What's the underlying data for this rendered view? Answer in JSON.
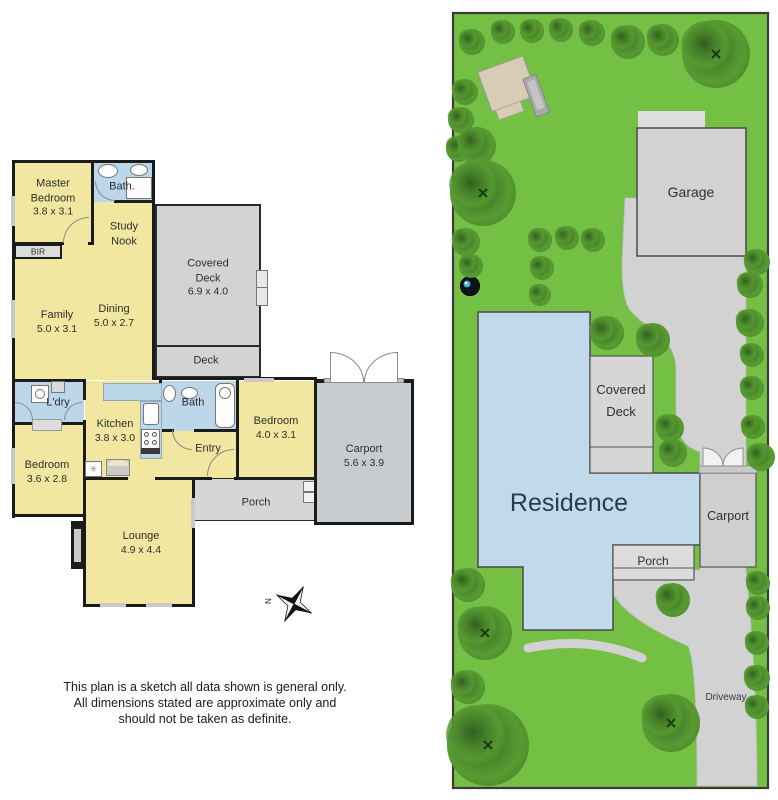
{
  "floorplan": {
    "labels": {
      "master_line1": "Master",
      "master_line2": "Bedroom",
      "master_dims": "3.8 x 3.1",
      "bath_top": "Bath.",
      "study_line1": "Study",
      "study_line2": "Nook",
      "bir": "BIR",
      "family": "Family",
      "family_dims": "5.0 x 3.1",
      "dining": "Dining",
      "dining_dims": "5.0 x 2.7",
      "covered_line1": "Covered",
      "covered_line2": "Deck",
      "covered_dims": "6.9 x 4.0",
      "deck": "Deck",
      "ldry": "L'dry",
      "kitchen": "Kitchen",
      "kitchen_dims": "3.8 x 3.0",
      "bath2": "Bath",
      "bedroom2": "Bedroom",
      "bedroom2_dims": "4.0 x 3.1",
      "entry": "Entry",
      "carport": "Carport",
      "carport_dims": "5.6 x 3.9",
      "bedroom3": "Bedroom",
      "bedroom3_dims": "3.6 x 2.8",
      "porch": "Porch",
      "lounge": "Lounge",
      "lounge_dims": "4.9 x 4.4",
      "compass_n": "N"
    }
  },
  "siteplan": {
    "labels": {
      "garage": "Garage",
      "covered_line1": "Covered",
      "covered_line2": "Deck",
      "residence": "Residence",
      "carport": "Carport",
      "porch": "Porch",
      "driveway": "Driveway"
    }
  },
  "disclaimer": {
    "line1": "This plan is a sketch all data shown is general only.",
    "line2": "All dimensions stated are approximate only and",
    "line3": "should not be taken as definite."
  },
  "colors": {
    "lawn": "#74c044",
    "tree": "#4e8a28",
    "residence_fill": "#c0d9eb",
    "room_yellow": "#f1e7a0",
    "wet_area_blue": "#bcd7ea",
    "deck_gray": "#d3d3d3",
    "wall": "#1b1b1b"
  }
}
